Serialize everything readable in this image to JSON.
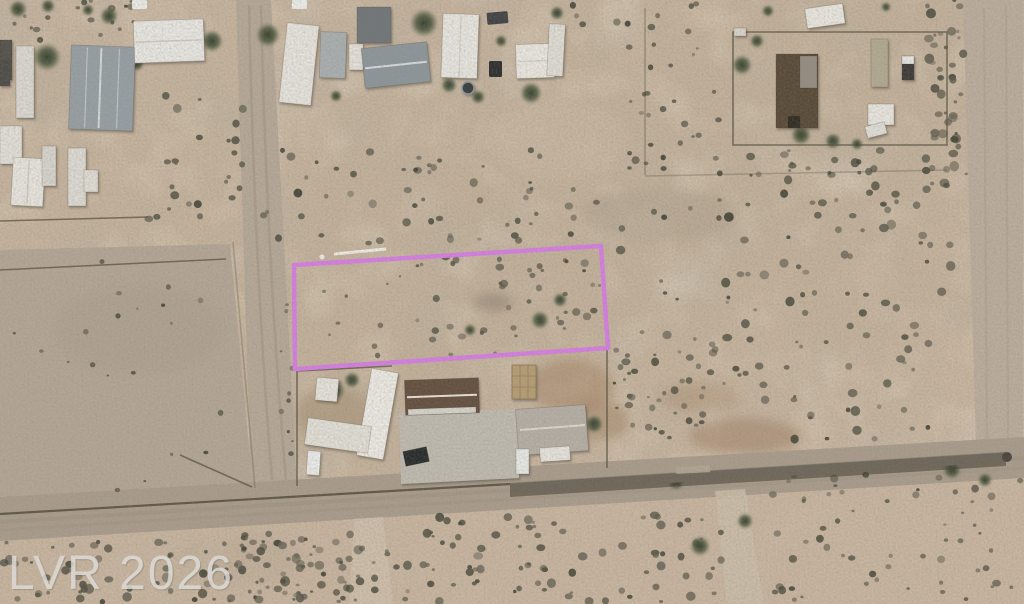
{
  "image": {
    "kind": "aerial satellite photo",
    "description": "Desert residential area with highlighted vacant land parcel",
    "width": 1024,
    "height": 604
  },
  "watermark": {
    "text": "LVR 2026",
    "color": "#dddcd8"
  },
  "parcel": {
    "points": "294,265 601,246 608,348 295,369",
    "outline_color": "#d97ee6"
  },
  "palette": {
    "desert_base": "#c7b59e",
    "road": "#aa9d8d",
    "field": "#b4a796",
    "wall": "#6e665a"
  }
}
